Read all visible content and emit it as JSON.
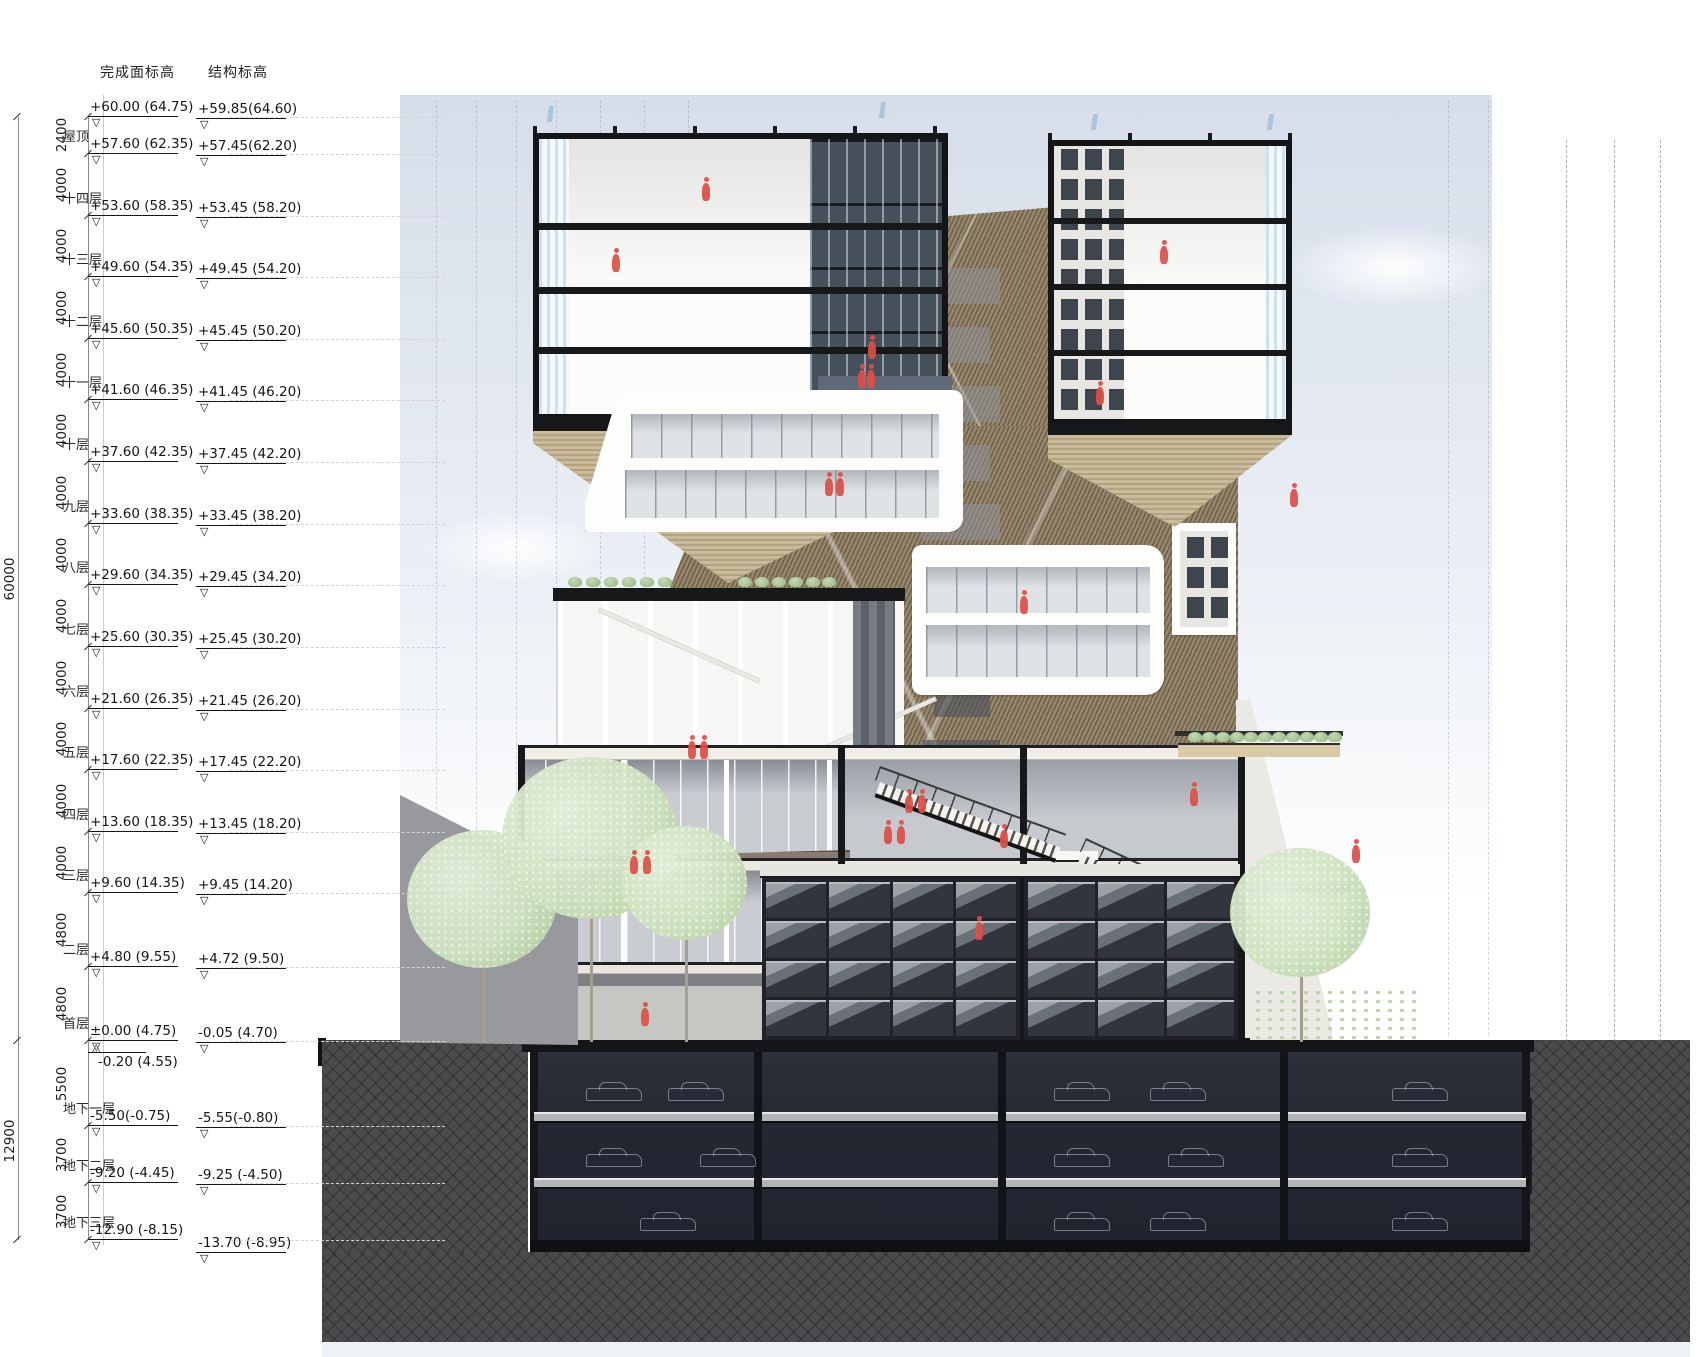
{
  "legend": {
    "header_finish": "完成面标高",
    "header_struct": "结构标高",
    "dim_total_upper": "60000",
    "dim_total_lower": "12900",
    "dims_mm": [
      "2400",
      "4000",
      "4000",
      "4000",
      "4000",
      "4000",
      "4000",
      "4000",
      "4000",
      "4000",
      "4000",
      "4000",
      "4000",
      "4800",
      "4800",
      "5500",
      "3700",
      "3700"
    ],
    "levels": [
      {
        "name": "",
        "finish": "+60.00 (64.75)",
        "struct": "+59.85(64.60)"
      },
      {
        "name": "屋顶",
        "finish": "+57.60 (62.35)",
        "struct": "+57.45(62.20)"
      },
      {
        "name": "十四层",
        "finish": "+53.60 (58.35)",
        "struct": "+53.45 (58.20)"
      },
      {
        "name": "十三层",
        "finish": "+49.60 (54.35)",
        "struct": "+49.45 (54.20)"
      },
      {
        "name": "十二层",
        "finish": "+45.60 (50.35)",
        "struct": "+45.45 (50.20)"
      },
      {
        "name": "十一层",
        "finish": "+41.60 (46.35)",
        "struct": "+41.45 (46.20)"
      },
      {
        "name": "十层",
        "finish": "+37.60 (42.35)",
        "struct": "+37.45 (42.20)"
      },
      {
        "name": "九层",
        "finish": "+33.60 (38.35)",
        "struct": "+33.45 (38.20)"
      },
      {
        "name": "八层",
        "finish": "+29.60 (34.35)",
        "struct": "+29.45 (34.20)"
      },
      {
        "name": "七层",
        "finish": "+25.60 (30.35)",
        "struct": "+25.45 (30.20)"
      },
      {
        "name": "六层",
        "finish": "+21.60 (26.35)",
        "struct": "+21.45 (26.20)"
      },
      {
        "name": "五层",
        "finish": "+17.60 (22.35)",
        "struct": "+17.45 (22.20)"
      },
      {
        "name": "四层",
        "finish": "+13.60 (18.35)",
        "struct": "+13.45 (18.20)"
      },
      {
        "name": "三层",
        "finish": "+9.60 (14.35)",
        "struct": "+9.45 (14.20)"
      },
      {
        "name": "二层",
        "finish": "+4.80 (9.55)",
        "struct": "+4.72 (9.50)"
      },
      {
        "name": "首层",
        "finish": "±0.00 (4.75)",
        "finish_sub": "-0.20 (4.55)",
        "struct": "-0.05 (4.70)"
      },
      {
        "name": "地下一层",
        "finish": "-5.50(-0.75)",
        "struct": "-5.55(-0.80)"
      },
      {
        "name": "地下二层",
        "finish": "-9.20 (-4.45)",
        "struct": "-9.25 (-4.50)"
      },
      {
        "name": "地下三层",
        "finish": "-12.90 (-8.15)",
        "struct": "-13.70 (-8.95)"
      }
    ]
  },
  "colors": {
    "sky_top": "#d6deea",
    "facade_brown": "#8b7c63",
    "earth": "#4a4b4d",
    "soil": "#8a5f35",
    "figure_red": "#dd4f46",
    "tree_green": "#cfe2c0",
    "slab_dark": "#17181a"
  },
  "scene": {
    "figures": [
      [
        702,
        183
      ],
      [
        612,
        254
      ],
      [
        868,
        341
      ],
      [
        1160,
        246
      ],
      [
        1096,
        387
      ],
      [
        858,
        370
      ],
      [
        867,
        370
      ],
      [
        825,
        478
      ],
      [
        836,
        478
      ],
      [
        1020,
        596
      ],
      [
        1290,
        489
      ],
      [
        688,
        741
      ],
      [
        700,
        741
      ],
      [
        630,
        856
      ],
      [
        643,
        856
      ],
      [
        905,
        795
      ],
      [
        918,
        795
      ],
      [
        1000,
        830
      ],
      [
        1190,
        788
      ],
      [
        1352,
        845
      ],
      [
        884,
        826
      ],
      [
        897,
        826
      ],
      [
        975,
        922
      ],
      [
        641,
        1008
      ]
    ],
    "trees": [
      [
        482,
        905,
        75
      ],
      [
        590,
        845,
        88
      ],
      [
        685,
        888,
        62
      ],
      [
        1300,
        918,
        70
      ]
    ],
    "cars": [
      [
        586,
        1088
      ],
      [
        668,
        1088
      ],
      [
        1054,
        1088
      ],
      [
        1150,
        1088
      ],
      [
        1392,
        1088
      ],
      [
        586,
        1154
      ],
      [
        700,
        1154
      ],
      [
        1054,
        1154
      ],
      [
        1168,
        1154
      ],
      [
        1392,
        1154
      ],
      [
        640,
        1218
      ],
      [
        1054,
        1218
      ],
      [
        1150,
        1218
      ],
      [
        1392,
        1218
      ]
    ],
    "flags": [
      [
        548,
        106
      ],
      [
        880,
        102
      ],
      [
        1092,
        114
      ],
      [
        1268,
        114
      ]
    ],
    "sky_grid_x": [
      436,
      476,
      516,
      556,
      600,
      644,
      688,
      1448,
      1488
    ],
    "construction_lines_x": [
      1566,
      1614,
      1660
    ],
    "pavilion_plants_x": [
      568,
      586,
      604,
      622,
      640,
      658,
      738,
      755,
      772,
      789,
      806,
      822
    ],
    "terrace_plants_x": [
      1188,
      1202,
      1216,
      1230,
      1244,
      1258,
      1272,
      1286,
      1300,
      1314,
      1328
    ]
  }
}
